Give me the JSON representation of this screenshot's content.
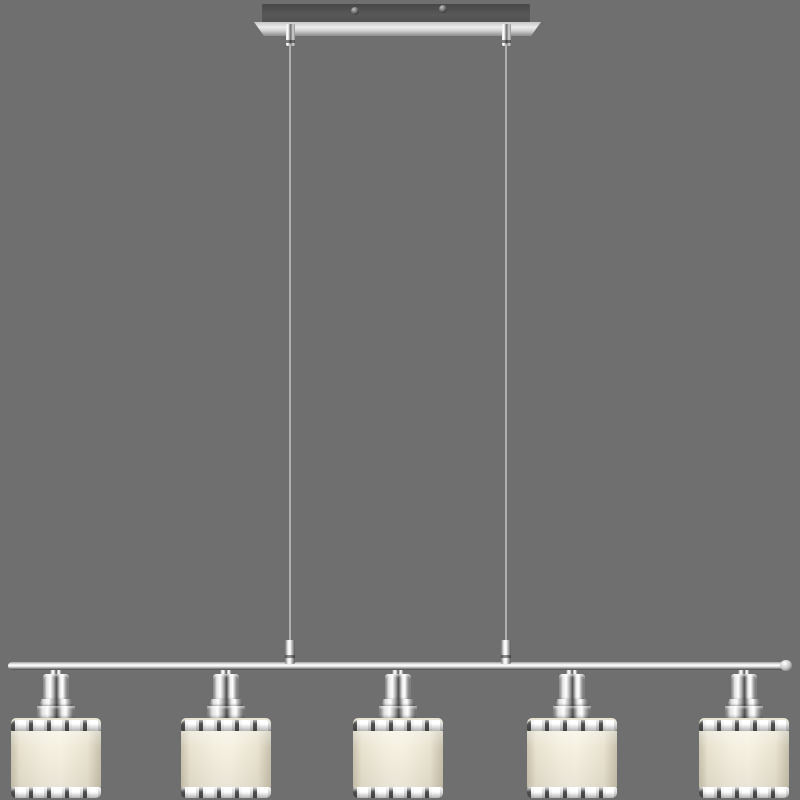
{
  "scene": {
    "description": "Product photo of a chrome five-light linear pendant ceiling lamp on a plain gray background. A dark rectangular ceiling canopy with two screws and a polished mount plate suspends a long chrome bar by two thin cables; five stepped chrome sockets each hold a cylindrical cream fabric drum shade trimmed with chrome dash-patterned rings at top and bottom.",
    "background_color": "#6F6F6F",
    "colors": {
      "background": "#6F6F6F",
      "canopy_dark": "#4E4E4E",
      "plate_silver": "#ECECEC",
      "chrome_bright": "#FFFFFF",
      "chrome_mid": "#BDBDBD",
      "chrome_dark": "#3F3F3F",
      "shade_cream": "#F4EFDF",
      "shade_cream_shadow": "#C9C3AE",
      "ring_dash_dark": "#3C3C3C",
      "wire_gray": "#B5B5B5"
    },
    "canopy": {
      "screw_count": 2
    },
    "suspension": {
      "wire_count": 2,
      "wires_x": [
        290,
        506
      ]
    },
    "lamps": {
      "count": 5,
      "centers_x": [
        56,
        226,
        398,
        572,
        744
      ],
      "shade_width": 90
    }
  }
}
